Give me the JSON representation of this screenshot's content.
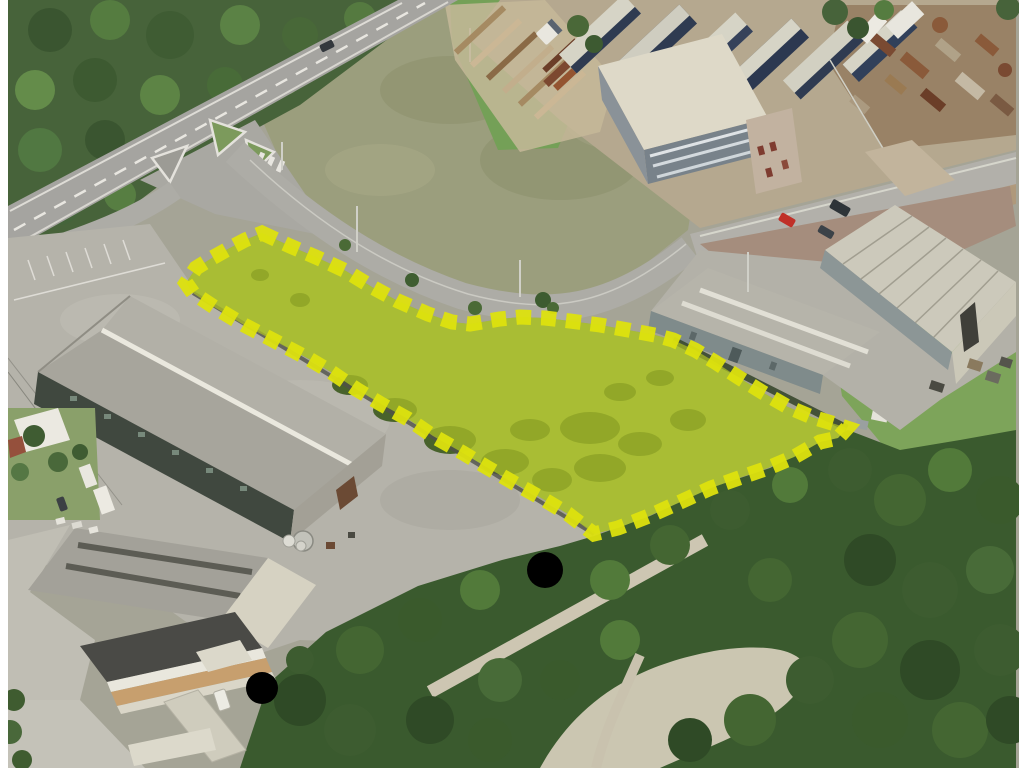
{
  "image": {
    "kind": "oblique-aerial-photo",
    "subject": "industrial zone with highlighted land parcel for sale",
    "width": 1024,
    "height": 768
  },
  "frame": {
    "bar_color": "#ffffff",
    "left_bar_px": 8,
    "right_bar_px": 5
  },
  "parcel_highlight": {
    "points": "262,233 290,246 318,258 346,271 372,287 398,301 428,314 452,322 470,324 500,319 520,317 545,318 570,321 600,325 628,330 655,335 673,340 695,350 715,362 738,377 762,392 788,407 812,417 835,424 847,428 838,438 820,442 794,457 768,468 739,478 711,488 678,503 649,516 618,528 594,534 568,514 543,499 514,483 488,468 463,453 433,436 408,419 381,404 356,389 331,372 309,359 288,348 269,338 244,325 214,307 193,293 186,283 196,268 212,258 228,249 245,240",
    "fill": "#c5d626",
    "fill_opacity": "0.6",
    "dash_color": "#dde20e",
    "dash_width": "15",
    "dasharray": "15 10",
    "dash_opacity": "0.95"
  },
  "palette": {
    "forest": "#4a6838",
    "field": "#9b9e7d",
    "road": "#a9a8a2",
    "concrete": "#b5b3aa",
    "warehouse_roof": "#a7a59c",
    "warehouse_wall_dark": "#40483f",
    "barrel_roof": "#ccc9bb",
    "office_roof": "#ddd8c7",
    "office_facade": "#78828a",
    "truck_navy": "#2f3b51",
    "truck_top": "#d6d4c6",
    "rust": "#7c4830",
    "gravel": "#cdc6b2",
    "meadow": "#7f9a4a",
    "highlight_fill": "#c5d626",
    "highlight_dash": "#dde20e"
  },
  "regions": [
    "forest-top-left",
    "main-road",
    "road-junction",
    "open-field",
    "timber-yard",
    "truck-depot",
    "scrap-yard",
    "office-building",
    "street-top-right",
    "paved-yard",
    "warehouse-flat-roof",
    "warehouse-barrel-roof",
    "big-warehouse",
    "house-left",
    "construction-office",
    "bottom-warehouse",
    "riverside-forest",
    "gravel-paths",
    "highlighted-parcel"
  ]
}
